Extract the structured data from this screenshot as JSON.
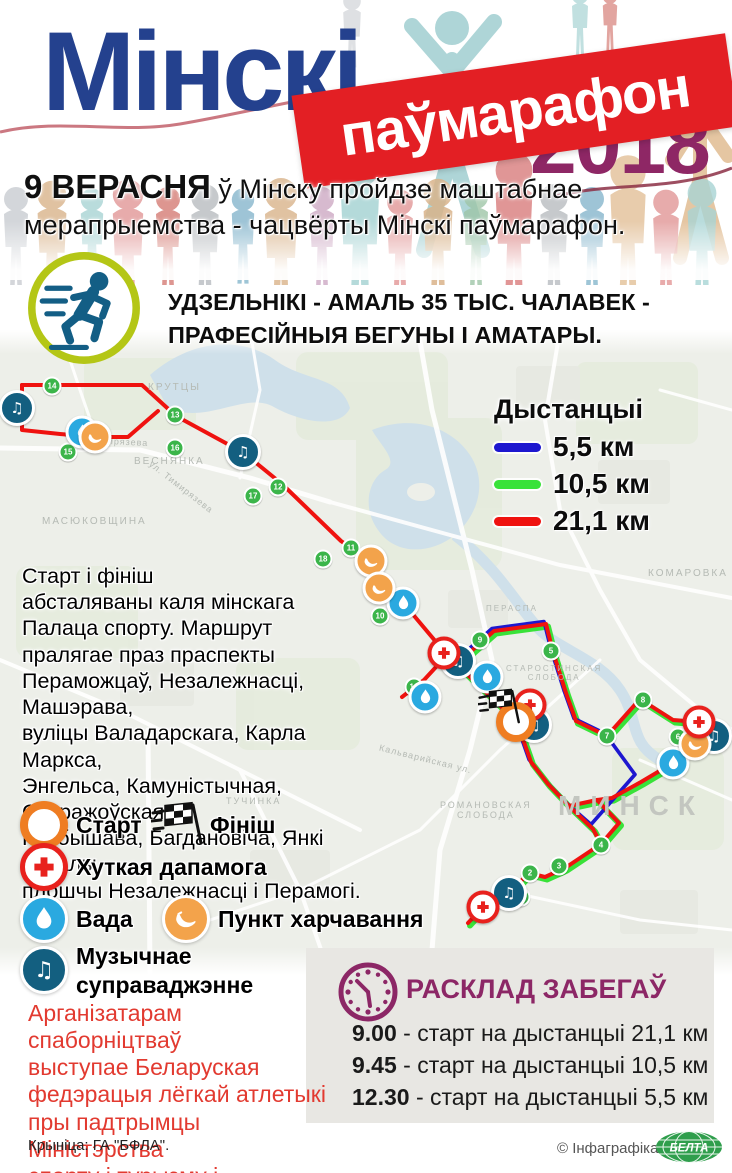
{
  "header": {
    "title": "Мінскі",
    "banner": "паўмарафон",
    "year": "2018",
    "date": "9 ВЕРАСНЯ",
    "intro": " ў Мінску пройдзе маштабнае мерапрыемства - чацвёрты Мінскі паўмарафон."
  },
  "participants": {
    "text": "УДЗЕЛЬНІКІ - АМАЛЬ 35 ТЫС. ЧАЛАВЕК -\nПРАФЕСІЙНЫЯ БЕГУНЫ І АМАТАРЫ."
  },
  "map": {
    "legend": {
      "title": "Дыстанцыі",
      "items": [
        {
          "label": "5,5 км",
          "color": "#1d17cf"
        },
        {
          "label": "10,5 км",
          "color": "#39e239"
        },
        {
          "label": "21,1 км",
          "color": "#ef120f"
        }
      ]
    },
    "description": "Старт і фініш\nабсталяваны каля мінскага\nПалаца спорту. Маршрут\nпралягае праз праспекты\nПераможцаў, Незалежнасці, Машэрава,\nвуліцы Валадарскага, Карла Маркса,\nЭнгельса, Камуністычная, Старажоўская,\nКуйбышава, Багдановіча, Янкі Купалы,\nплошчы Незалежнасці і Перамогі.",
    "marker_legend": [
      {
        "type": "start",
        "label": "Старт"
      },
      {
        "type": "finish",
        "label": "Фініш"
      },
      {
        "type": "medical",
        "label": "Хуткая дапамога"
      },
      {
        "type": "water",
        "label": "Вада"
      },
      {
        "type": "food",
        "label": "Пункт харчавання"
      },
      {
        "type": "music",
        "label": "Музычнае\nсуправаджэнне"
      }
    ],
    "labels": [
      "КРУТЦЫ",
      "ВЕСНЯНКА",
      "МАСЮКОВЩИНА",
      "КОМАРОВКА",
      "ТУЧИНКА",
      "МИНСК",
      "РОМАНОВСКАЯ\nСЛОБОДА",
      "ПЕРАСПА",
      "СТАРОСТИНСКАЯ\nСЛОБОДА",
      "ул. Тимирязева",
      "ул. Тимирязева",
      "Кальварийская ул."
    ],
    "markers": [
      {
        "type": "music",
        "x": 17,
        "y": 408
      },
      {
        "type": "music",
        "x": 243,
        "y": 452
      },
      {
        "type": "music",
        "x": 458,
        "y": 661
      },
      {
        "type": "music",
        "x": 534,
        "y": 725
      },
      {
        "type": "music",
        "x": 714,
        "y": 736
      },
      {
        "type": "music",
        "x": 509,
        "y": 893
      },
      {
        "type": "water",
        "x": 82,
        "y": 432
      },
      {
        "type": "water",
        "x": 403,
        "y": 603
      },
      {
        "type": "water",
        "x": 487,
        "y": 677
      },
      {
        "type": "water",
        "x": 425,
        "y": 697
      },
      {
        "type": "water",
        "x": 673,
        "y": 763
      },
      {
        "type": "food",
        "x": 95,
        "y": 437
      },
      {
        "type": "food",
        "x": 371,
        "y": 561
      },
      {
        "type": "food",
        "x": 379,
        "y": 588
      },
      {
        "type": "food",
        "x": 695,
        "y": 744
      },
      {
        "type": "medical",
        "x": 444,
        "y": 653
      },
      {
        "type": "medical",
        "x": 530,
        "y": 705
      },
      {
        "type": "medical",
        "x": 699,
        "y": 722
      },
      {
        "type": "medical",
        "x": 483,
        "y": 907
      },
      {
        "type": "start",
        "x": 516,
        "y": 722
      },
      {
        "type": "finish",
        "x": 500,
        "y": 705
      }
    ],
    "km_markers": [
      {
        "n": "14",
        "x": 52,
        "y": 386
      },
      {
        "n": "13",
        "x": 175,
        "y": 415
      },
      {
        "n": "15",
        "x": 68,
        "y": 452
      },
      {
        "n": "16",
        "x": 175,
        "y": 448
      },
      {
        "n": "12",
        "x": 278,
        "y": 487
      },
      {
        "n": "17",
        "x": 253,
        "y": 496
      },
      {
        "n": "11",
        "x": 351,
        "y": 548
      },
      {
        "n": "18",
        "x": 323,
        "y": 559
      },
      {
        "n": "10",
        "x": 380,
        "y": 616
      },
      {
        "n": "19",
        "x": 414,
        "y": 687
      },
      {
        "n": "9",
        "x": 480,
        "y": 640
      },
      {
        "n": "5",
        "x": 551,
        "y": 651
      },
      {
        "n": "8",
        "x": 643,
        "y": 700
      },
      {
        "n": "7",
        "x": 607,
        "y": 736
      },
      {
        "n": "6",
        "x": 678,
        "y": 737
      },
      {
        "n": "4",
        "x": 601,
        "y": 845
      },
      {
        "n": "3",
        "x": 559,
        "y": 866
      },
      {
        "n": "2",
        "x": 530,
        "y": 873
      },
      {
        "n": "1",
        "x": 521,
        "y": 897
      }
    ]
  },
  "schedule": {
    "title": "РАСКЛАД ЗАБЕГАЎ",
    "items": [
      {
        "time": "9.00",
        "text": "- старт на дыстанцыі 21,1 км"
      },
      {
        "time": "9.45",
        "text": "- старт на дыстанцыі 10,5 км"
      },
      {
        "time": "12.30",
        "text": "- старт на дыстанцыі 5,5 км"
      }
    ]
  },
  "organizers": "Арганізатарам спаборніцтваў\nвыступае Беларуская\nфедэрацыя лёгкай атлетыкі\nпры падтрымцы Міністэрства\nспорту і турызму і\nМінгарвыканкама.",
  "footer": {
    "source": "Крыніца: ГА \"БФЛА\".",
    "credit": "© Інфаграфіка",
    "logo": "БЕЛТА"
  },
  "colors": {
    "title_blue": "#24418e",
    "banner_red": "#e31f24",
    "year_purple": "#8e2765",
    "route_blue": "#1d17cf",
    "route_green": "#39e239",
    "route_red": "#ef120f",
    "schedule_purple": "#8c2766",
    "note_red": "#e23a30",
    "belta_green": "#2f9e4c",
    "runner_ring": "#b4c616",
    "runner_figure": "#135e85"
  }
}
